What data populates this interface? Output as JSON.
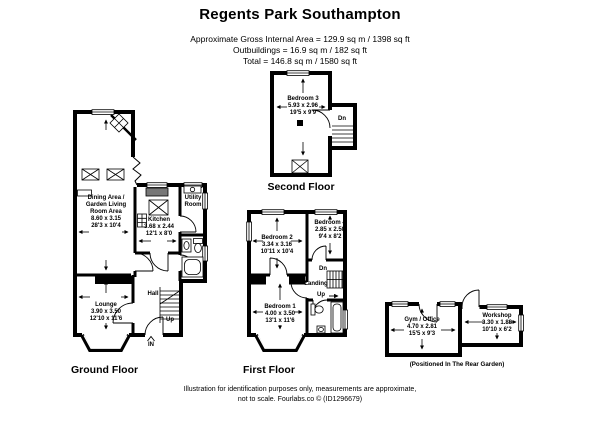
{
  "page": {
    "title": "Regents Park Southampton",
    "area_lines": [
      "Approximate Gross Internal Area = 129.9 sq m / 1398 sq ft",
      "Outbuildings = 16.9 sq m / 182 sq ft",
      "Total = 146.8 sq m / 1580 sq ft"
    ],
    "footer_lines": [
      "Illustration for identification purposes only, measurements are approximate,",
      "not to scale. Fourlabs.co © (ID1296679)"
    ]
  },
  "floors": {
    "second": {
      "label": "Second Floor",
      "rooms": {
        "bedroom3": {
          "name": "Bedroom 3",
          "metric": "5.93 x 2.96",
          "imperial": "19'5 x 9'9"
        }
      },
      "annotations": {
        "dn": "Dn"
      }
    },
    "ground": {
      "label": "Ground Floor",
      "rooms": {
        "dining": {
          "name_lines": [
            "Dining Area /",
            "Garden Living",
            "Room Area"
          ],
          "metric": "8.60 x 3.15",
          "imperial": "28'3 x 10'4"
        },
        "kitchen": {
          "name": "Kitchen",
          "metric": "3.68 x 2.44",
          "imperial": "12'1 x 8'0"
        },
        "utility": {
          "name_lines": [
            "Utility",
            "Room"
          ]
        },
        "lounge": {
          "name": "Lounge",
          "metric": "3.90 x 3.50",
          "imperial": "12'10 x 11'6"
        }
      },
      "annotations": {
        "hall": "Hall",
        "up": "Up",
        "in": "IN"
      }
    },
    "first": {
      "label": "First Floor",
      "rooms": {
        "bedroom2": {
          "name": "Bedroom 2",
          "metric": "3.34 x 3.16",
          "imperial": "10'11 x 10'4"
        },
        "bedroom4": {
          "name": "Bedroom 4",
          "metric": "2.85 x 2.50",
          "imperial": "9'4 x 8'2"
        },
        "bedroom1": {
          "name": "Bedroom 1",
          "metric": "4.00 x 3.50",
          "imperial": "13'1 x 11'6"
        }
      },
      "annotations": {
        "dn": "Dn",
        "landing": "Landing",
        "up": "Up"
      }
    },
    "outbuildings": {
      "caption": "(Positioned In The Rear Garden)",
      "rooms": {
        "gym_office": {
          "name": "Gym / Office",
          "metric": "4.70 x 2.81",
          "imperial": "15'5 x 9'3"
        },
        "workshop": {
          "name": "Workshop",
          "metric": "3.30 x 1.88",
          "imperial": "10'10 x 6'2"
        }
      }
    }
  },
  "colors": {
    "wall": "#000000",
    "background": "#ffffff",
    "text": "#000000"
  }
}
